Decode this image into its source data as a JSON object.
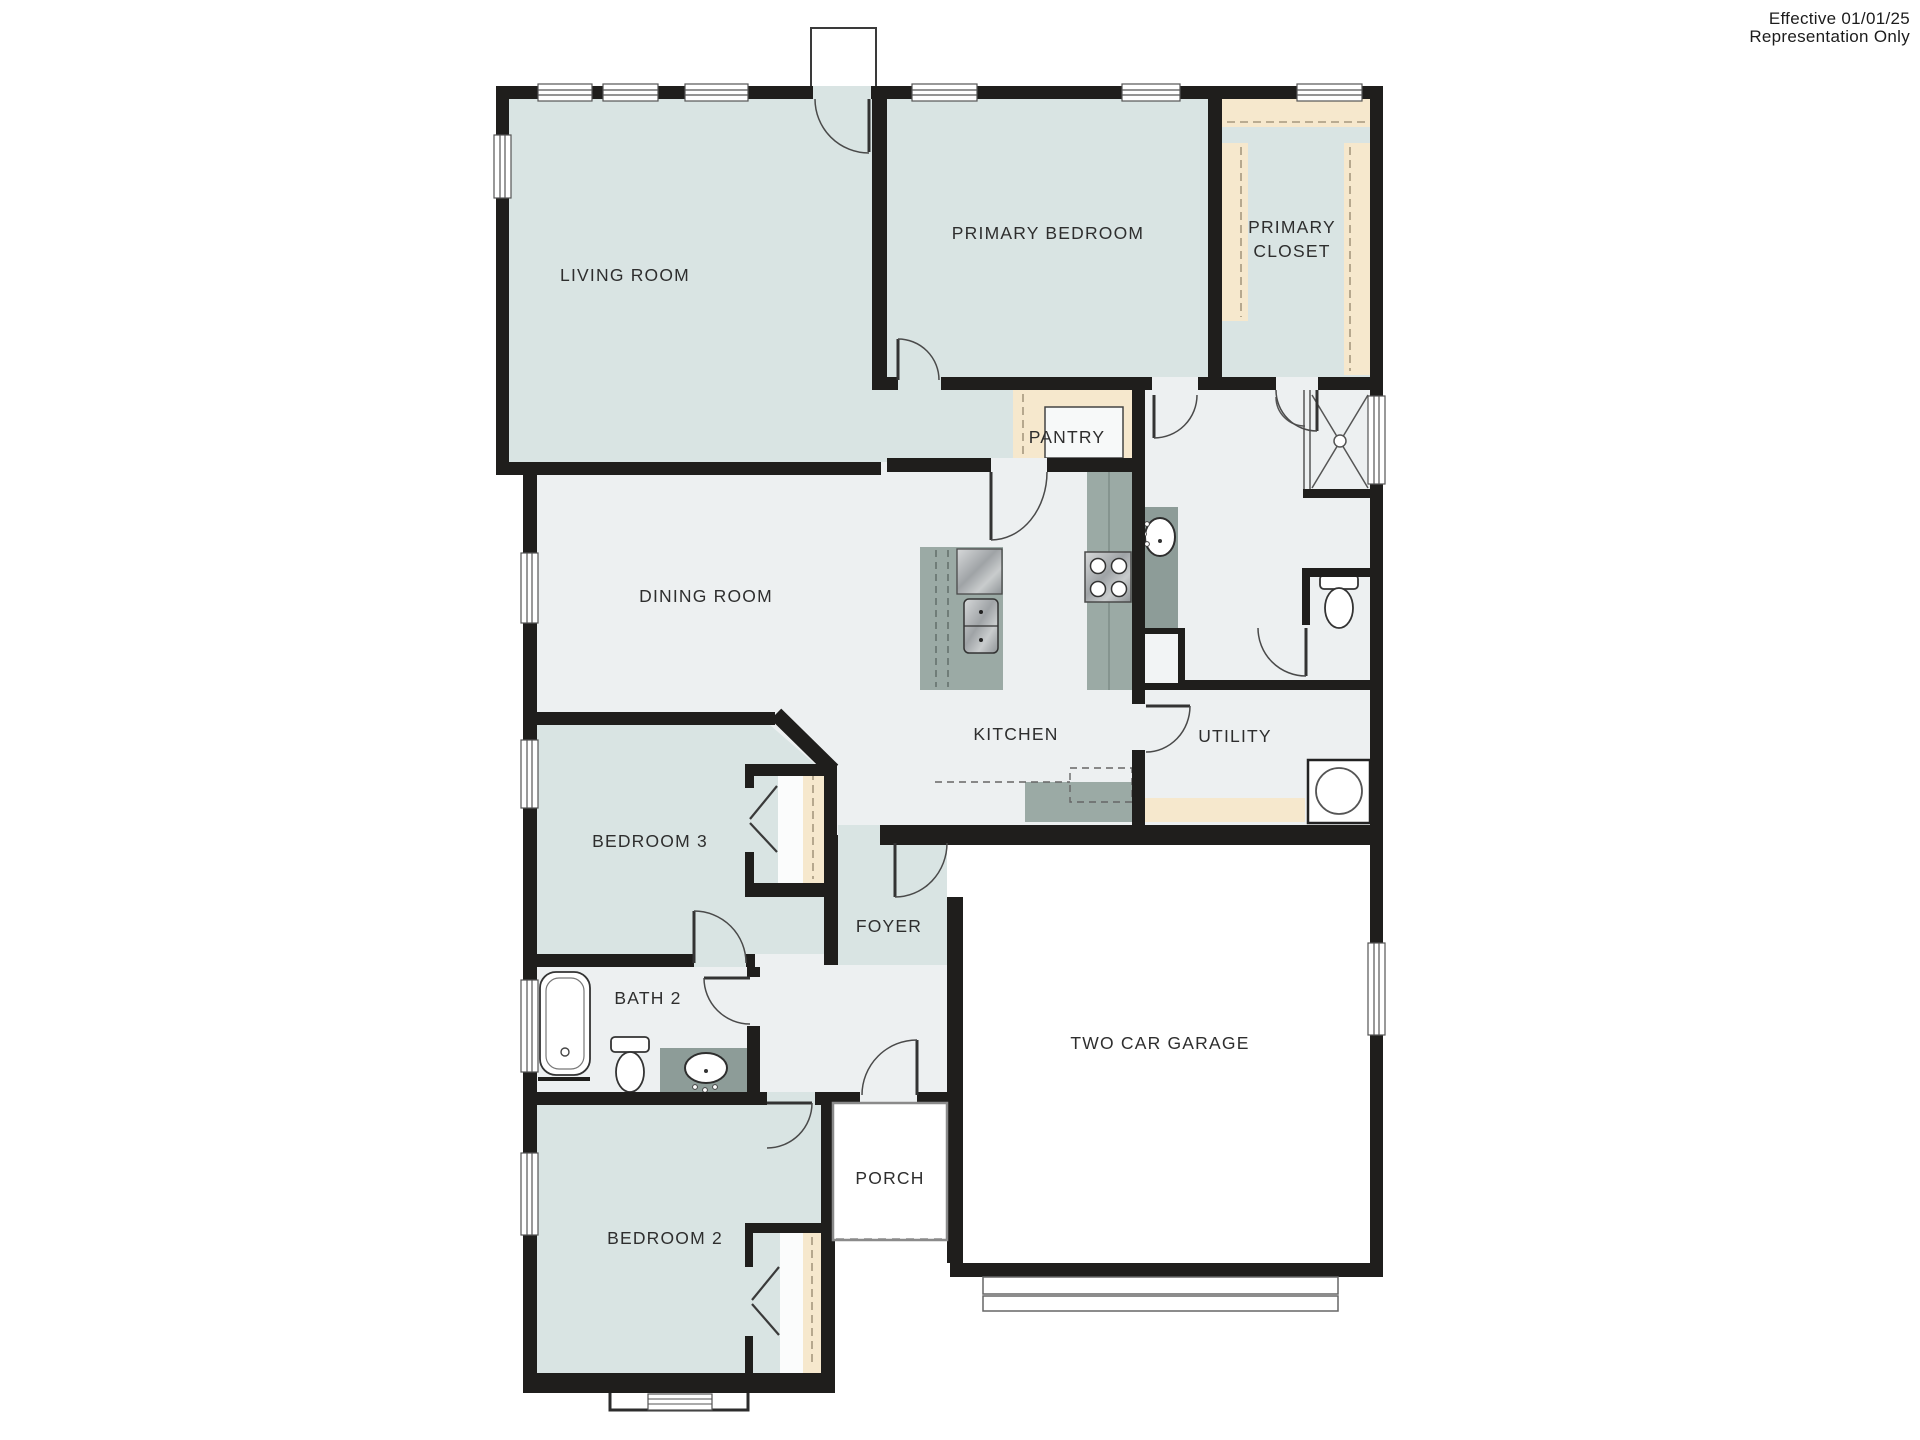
{
  "annotation": {
    "line1": "Effective 01/01/25",
    "line2": "Representation Only"
  },
  "rooms": {
    "living_room": "LIVING ROOM",
    "primary_bedroom": "PRIMARY BEDROOM",
    "primary_closet_line1": "PRIMARY",
    "primary_closet_line2": "CLOSET",
    "pantry": "PANTRY",
    "dining_room": "DINING ROOM",
    "kitchen": "KITCHEN",
    "utility": "UTILITY",
    "bedroom_3": "BEDROOM 3",
    "foyer": "FOYER",
    "bath_2": "BATH 2",
    "bedroom_2": "BEDROOM 2",
    "porch": "PORCH",
    "garage": "TWO CAR GARAGE"
  },
  "colors": {
    "wall": "#1f1e1c",
    "room_blue": "#d9e4e3",
    "floor_gray": "#edf0f1",
    "closet_tan": "#f6e8cd",
    "counter": "#9baaa5",
    "counter_dark": "#8d9c98",
    "exterior_white": "#ffffff"
  },
  "fixtures": {
    "bathtub": "bathtub",
    "toilet_bath2": "toilet",
    "toilet_primary": "toilet",
    "shower_primary": "shower",
    "sink_bath2": "oval sink",
    "sink_primary": "oval sink",
    "kitchen_sink": "double sink",
    "dishwasher": "dishwasher",
    "stove": "4-burner stove",
    "washer": "washer",
    "garage_door": "garage door",
    "bay_window": "bay window"
  }
}
